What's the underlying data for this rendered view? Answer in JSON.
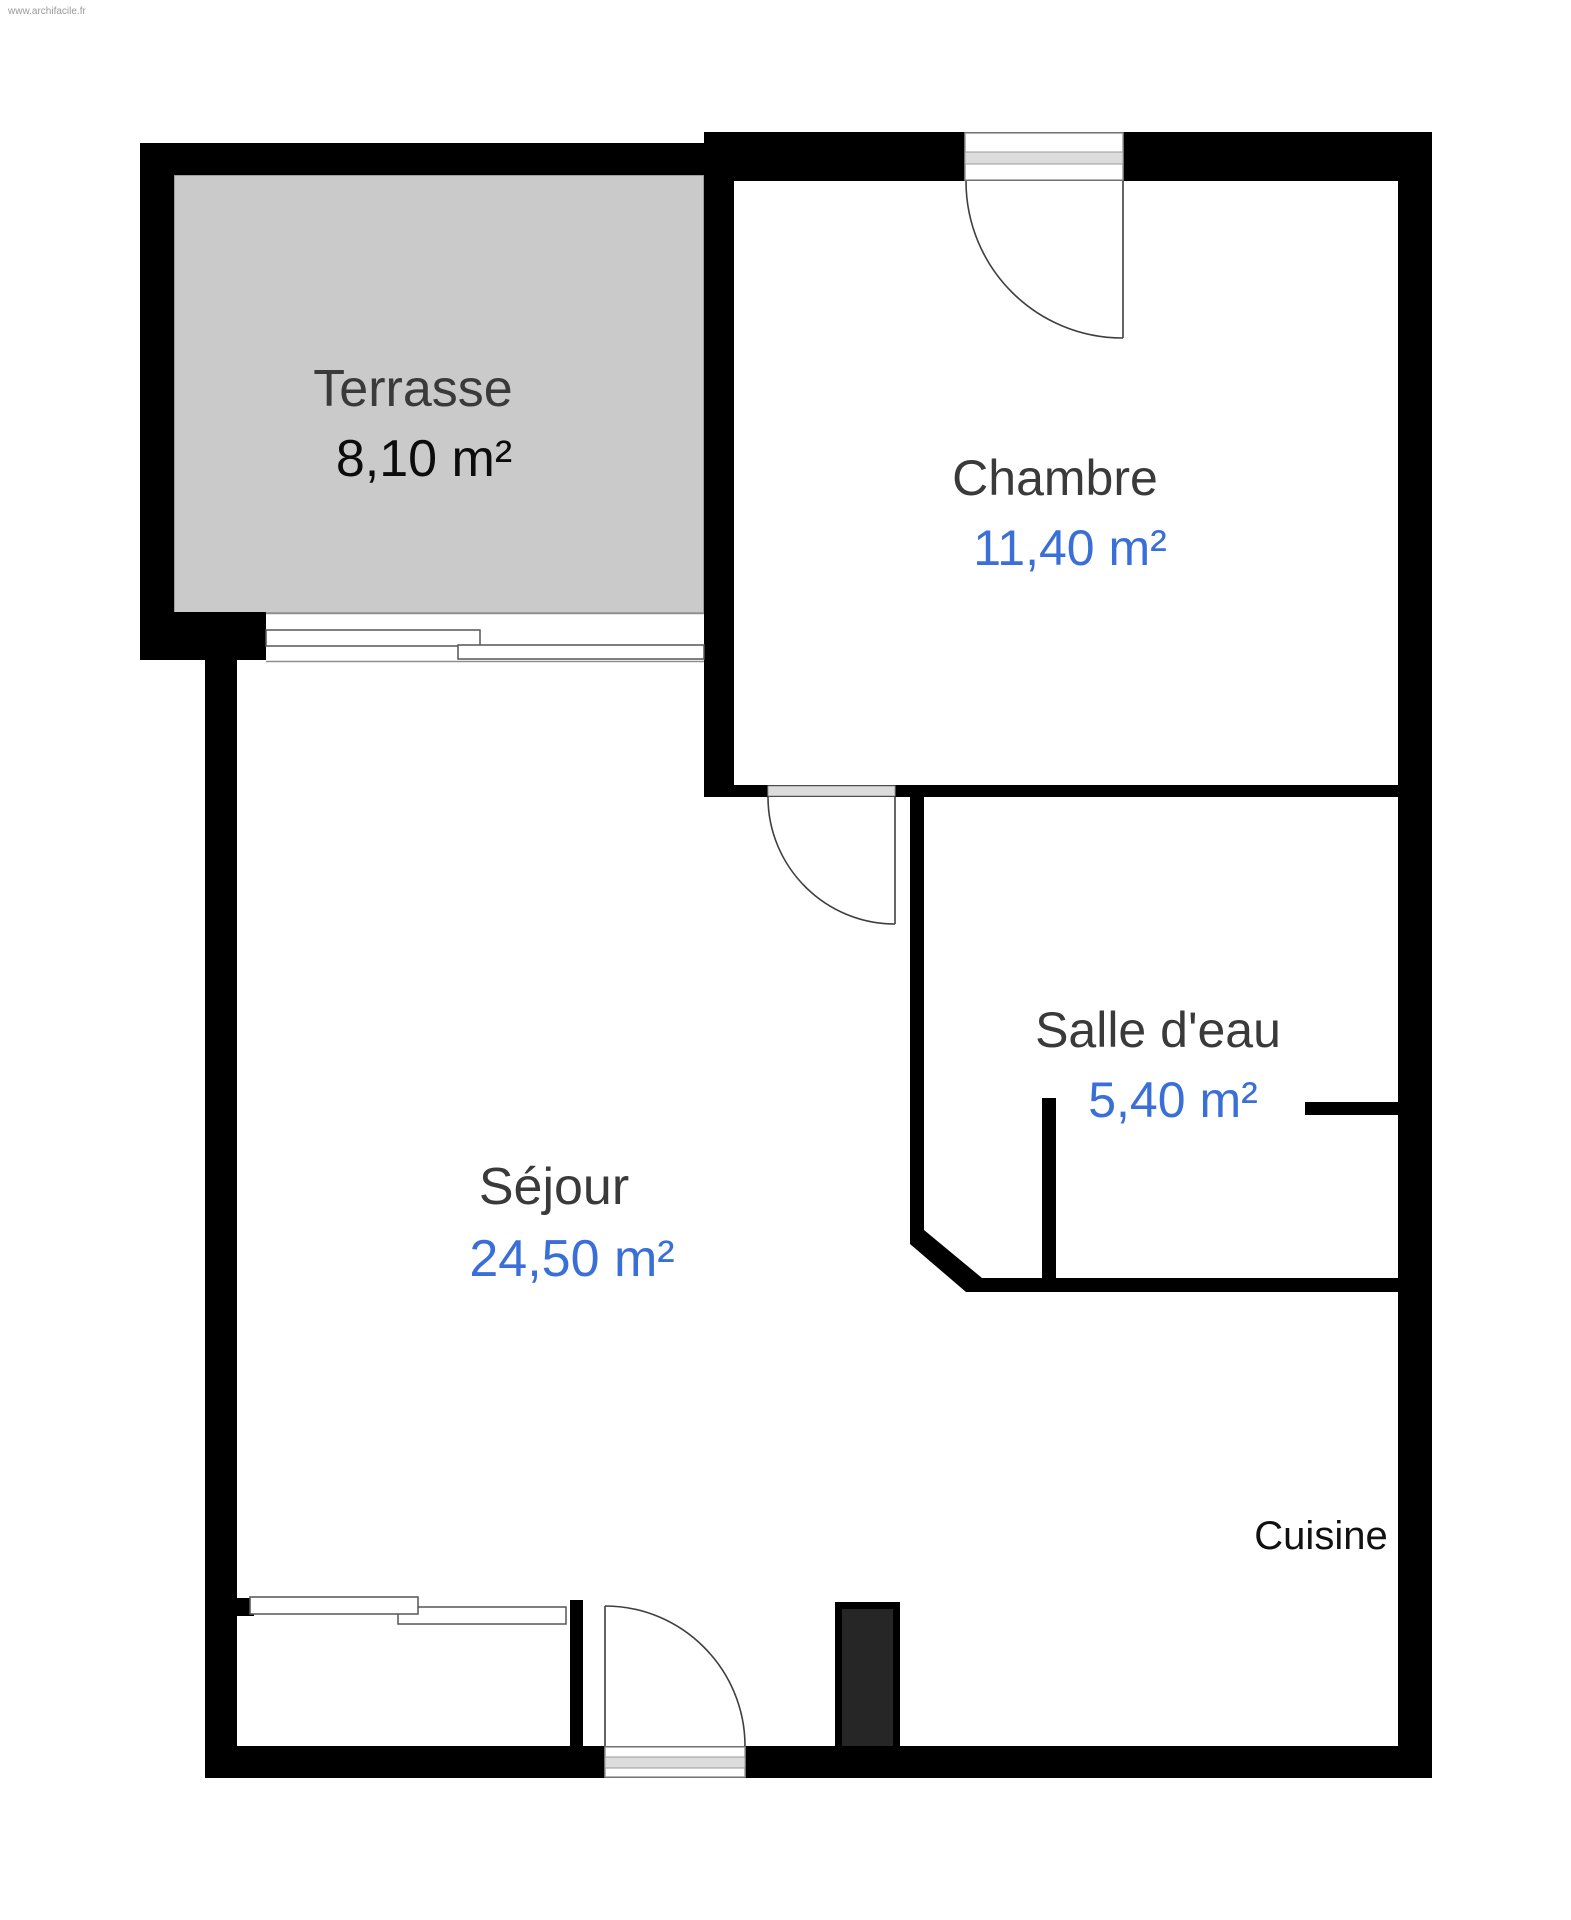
{
  "watermark": "www.archifacile.fr",
  "colors": {
    "wall": "#000000",
    "terrace_fill": "#cacaca",
    "accent_blue": "#3a6fd8",
    "room_label": "#3a3a3a",
    "terrace_area": "#0c0c0c",
    "cuisine_label": "#111111",
    "threshold_gray": "#dcdcdc",
    "duct_fill": "#262626"
  },
  "rooms": {
    "terrasse": {
      "name": "Terrasse",
      "area": "8,10 m²"
    },
    "chambre": {
      "name": "Chambre",
      "area": "11,40 m²"
    },
    "salle_deau": {
      "name": "Salle d'eau",
      "area": "5,40 m²"
    },
    "sejour": {
      "name": "Séjour",
      "area": "24,50 m²"
    },
    "cuisine": {
      "name": "Cuisine"
    }
  }
}
